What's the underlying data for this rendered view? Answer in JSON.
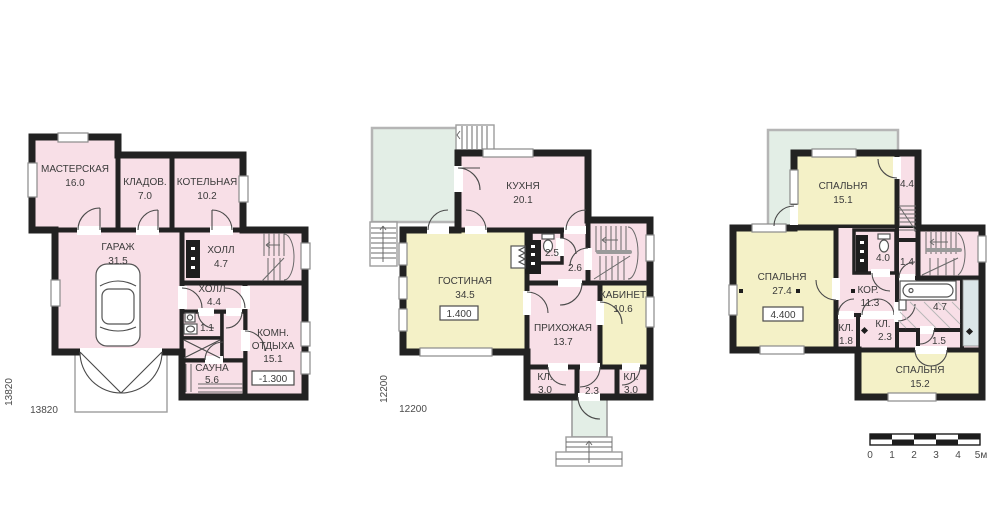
{
  "title": "house-floor-plans",
  "colors": {
    "room_pink": "#f8dfe7",
    "room_yellow": "#f4f1c7",
    "terrace_green": "#e3eee6",
    "balcony_blue": "#dbe6e8",
    "wall_black": "#222222",
    "text": "#3b3b3b"
  },
  "floors": [
    {
      "id": "basement",
      "dim_vertical": "13820",
      "dim_horizontal": "13820",
      "level_mark": "-1.300",
      "rooms": {
        "masterskaya": {
          "name": "МАСТЕРСКАЯ",
          "area": "16.0"
        },
        "kladovaya": {
          "name": "КЛАДОВ.",
          "area": "7.0"
        },
        "kotelnaya": {
          "name": "КОТЕЛЬНАЯ",
          "area": "10.2"
        },
        "garazh": {
          "name": "ГАРАЖ",
          "area": "31.5"
        },
        "holl_top": {
          "name": "ХОЛЛ",
          "area": "4.7"
        },
        "holl_mid": {
          "name": "ХОЛЛ",
          "area": "4.4"
        },
        "wc": {
          "area": "1.1"
        },
        "komn_otdyha": {
          "name1": "КОМН.",
          "name2": "ОТДЫХА",
          "area": "15.1"
        },
        "sauna": {
          "name": "САУНА",
          "area": "5.6"
        }
      }
    },
    {
      "id": "first-floor",
      "dim_vertical": "12200",
      "dim_horizontal": "12200",
      "level_mark": "1.400",
      "rooms": {
        "kuhnya": {
          "name": "КУХНЯ",
          "area": "20.1"
        },
        "gostinaya": {
          "name": "ГОСТИНАЯ",
          "area": "34.5"
        },
        "wc": {
          "area": "2.5"
        },
        "hall": {
          "area": "2.6"
        },
        "prihozhaya": {
          "name": "ПРИХОЖАЯ",
          "area": "13.7"
        },
        "kabinet": {
          "name": "КАБИНЕТ",
          "area": "10.6"
        },
        "kl_left": {
          "name": "КЛ.",
          "area": "3.0"
        },
        "corridor": {
          "area": "2.3"
        },
        "kl_right": {
          "name": "КЛ.",
          "area": "3.0"
        }
      }
    },
    {
      "id": "second-floor",
      "level_mark": "4.400",
      "rooms": {
        "spalnya_top": {
          "name": "СПАЛЬНЯ",
          "area": "15.1"
        },
        "r44": {
          "area": "4.4"
        },
        "spalnya_left": {
          "name": "СПАЛЬНЯ",
          "area": "27.4"
        },
        "wc": {
          "area": "4.0"
        },
        "r14": {
          "area": "1.4"
        },
        "koridor": {
          "name": "КОР.",
          "area": "11.3"
        },
        "vannaya": {
          "area": "4.7"
        },
        "r15": {
          "area": "1.5"
        },
        "kl_left": {
          "name": "КЛ.",
          "area": "1.8"
        },
        "kl_mid": {
          "name": "КЛ.",
          "area": "2.3"
        },
        "spalnya_bottom": {
          "name": "СПАЛЬНЯ",
          "area": "15.2"
        }
      }
    }
  ],
  "scale_bar": {
    "labels": [
      "0",
      "1",
      "2",
      "3",
      "4",
      "5м"
    ]
  }
}
